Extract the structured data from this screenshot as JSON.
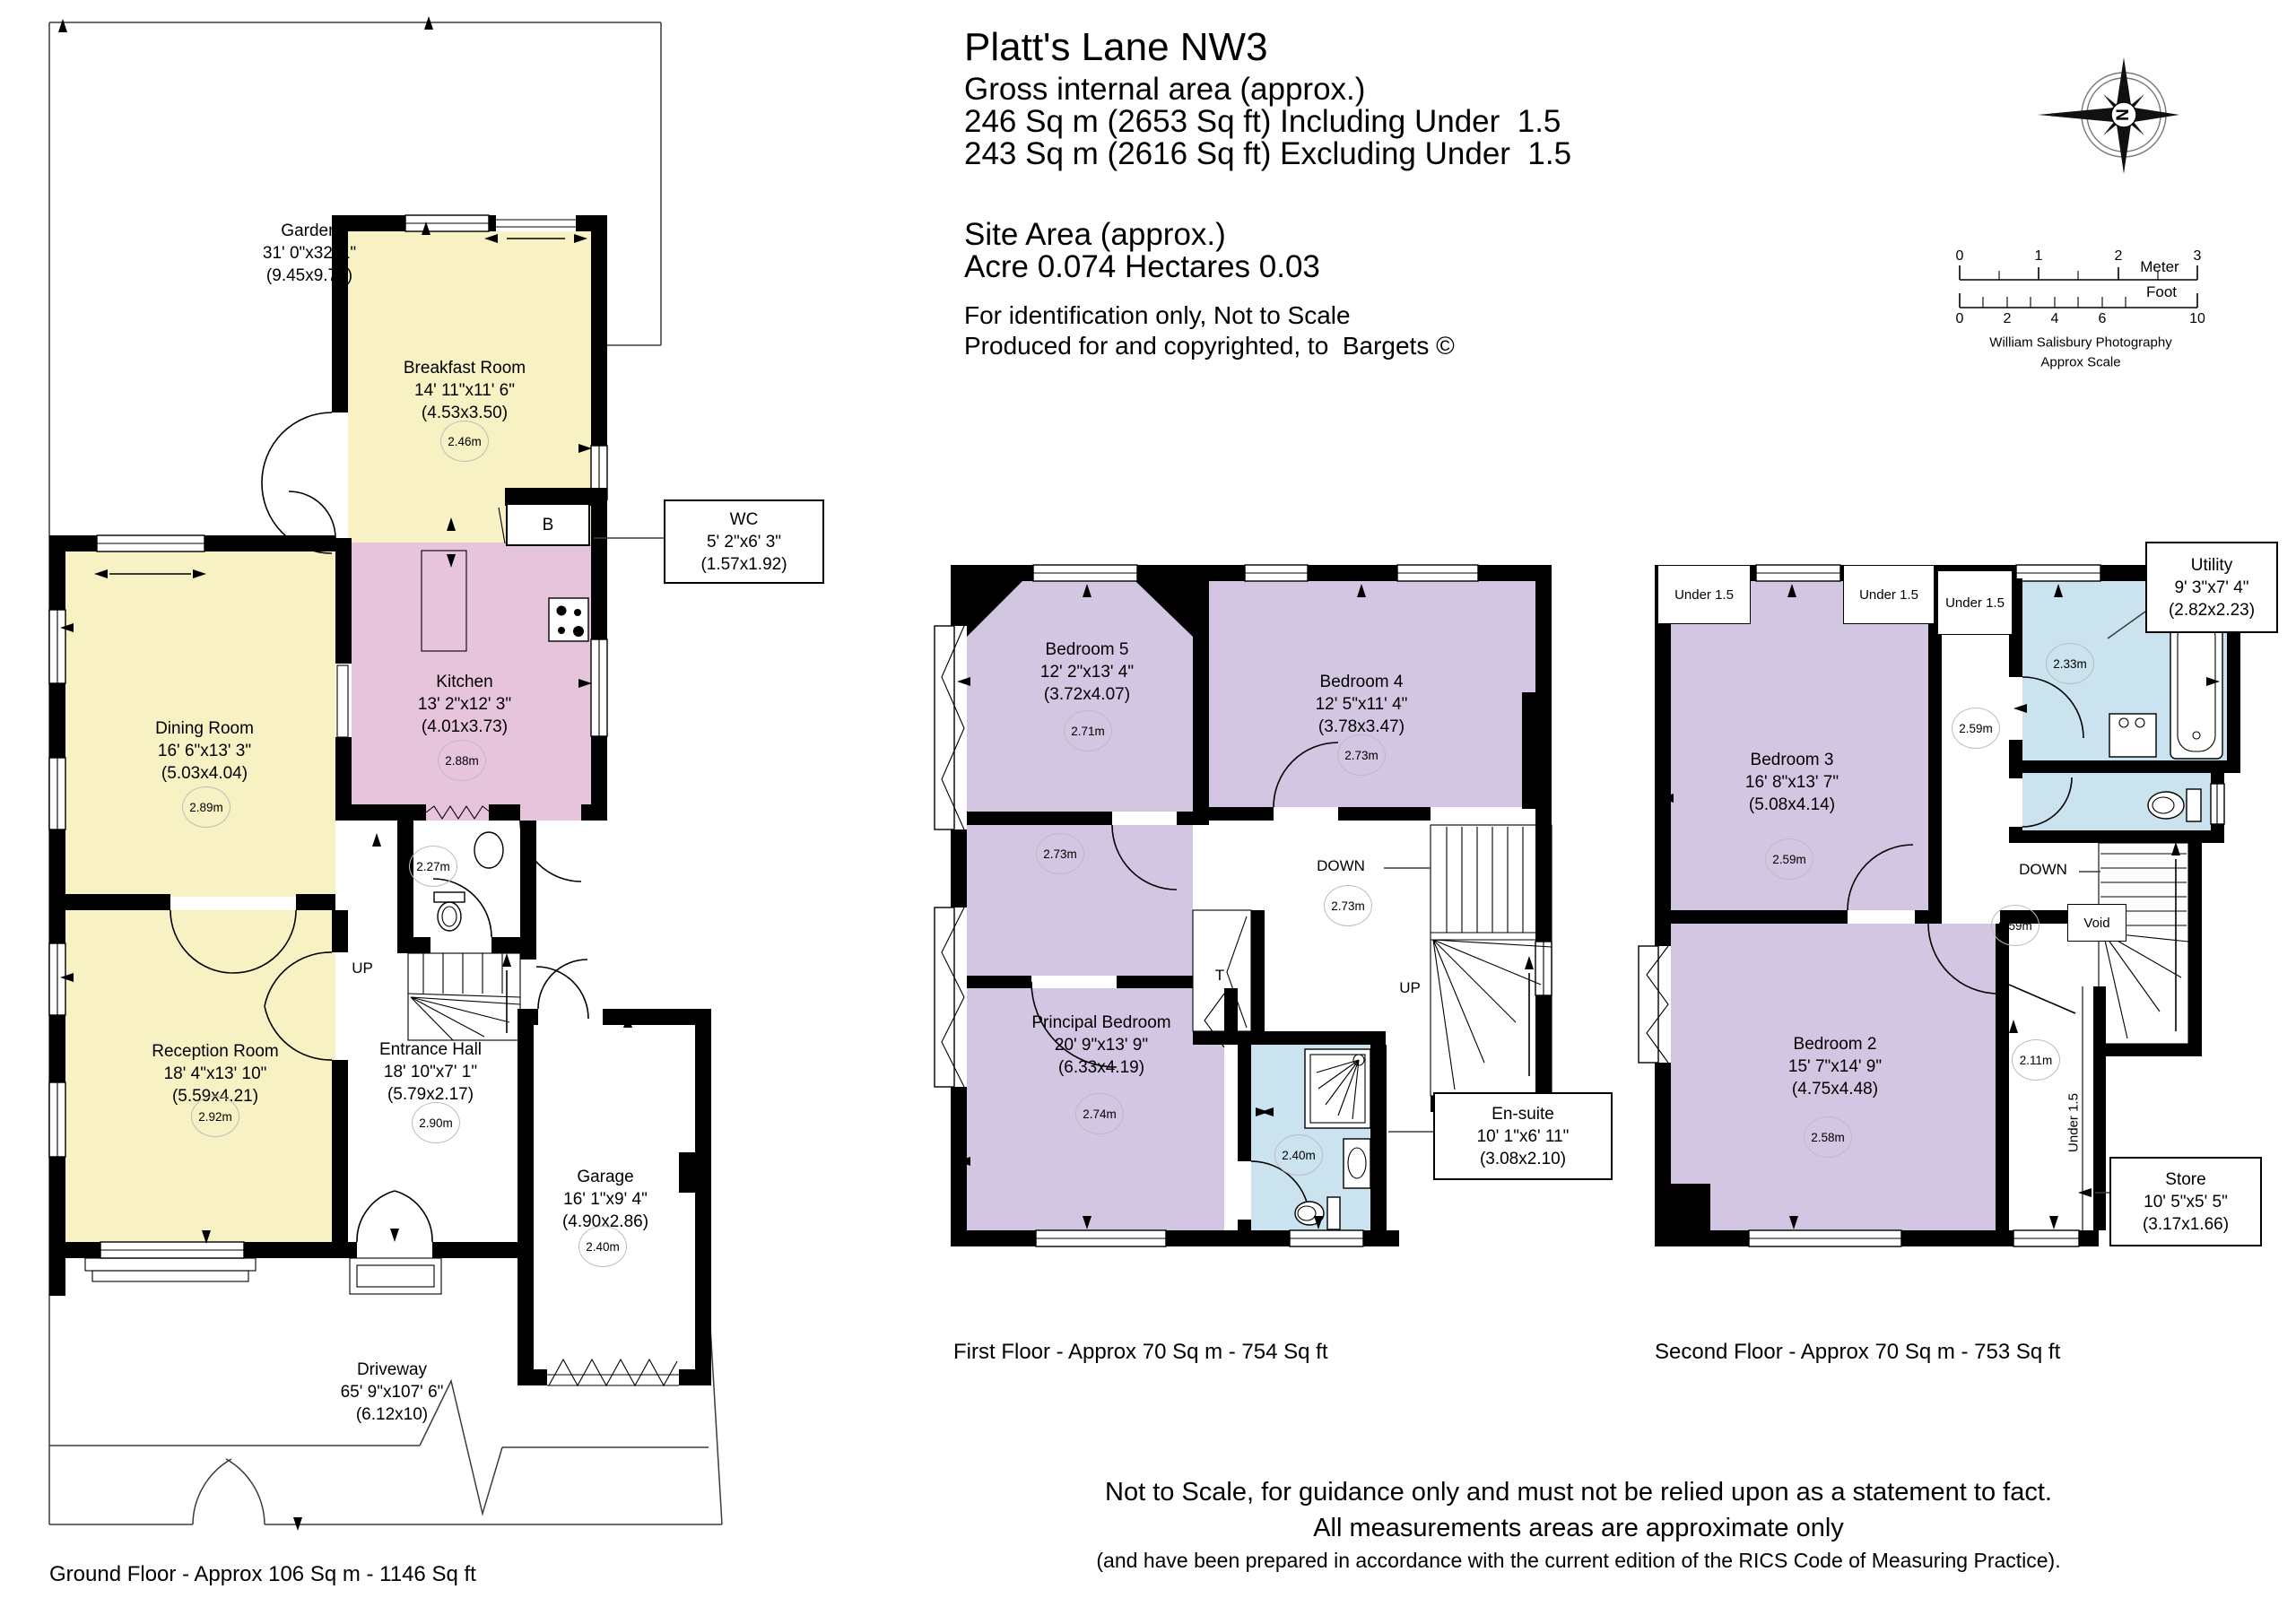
{
  "header": {
    "title": "Platt's Lane NW3",
    "gross_label": "Gross internal area (approx.)",
    "gross_line1": "246 Sq m (2653 Sq ft) Including Under  1.5",
    "gross_line2": "243 Sq m (2616 Sq ft) Excluding Under  1.5",
    "site_area_label": "Site Area (approx.)",
    "site_area_value": "Acre 0.074 Hectares 0.03",
    "note1": "For identification only, Not to Scale",
    "note2": "Produced for and copyrighted, to  Bargets ©"
  },
  "compass": {
    "north": "N"
  },
  "scale_bar": {
    "meter_ticks": [
      "0",
      "1",
      "2",
      "3"
    ],
    "meter_label": "Meter",
    "foot_ticks": [
      "0",
      "2",
      "4",
      "6",
      "10"
    ],
    "foot_label": "Foot",
    "credit1": "William Salisbury Photography",
    "credit2": "Approx Scale"
  },
  "colors": {
    "c-yellow": "#F8F1C4",
    "c-pink": "#E6C4DC",
    "c-purple": "#D3C6E2",
    "c-blue": "#CBE3EF",
    "c-wall": "#000000"
  },
  "ground_floor": {
    "caption": "Ground Floor - Approx 106 Sq m - 1146 Sq ft",
    "garden": {
      "name": "Garden",
      "dims_ft": "31' 0\"x32' 1\"",
      "dims_m": "(9.45x9.77)"
    },
    "driveway": {
      "name": "Driveway",
      "dims_ft": "65' 9\"x107' 6\"",
      "dims_m": "(6.12x10)"
    },
    "breakfast": {
      "name": "Breakfast Room",
      "dims_ft": "14' 11\"x11' 6\"",
      "dims_m": "(4.53x3.50)",
      "height": "2.46m"
    },
    "kitchen": {
      "name": "Kitchen",
      "dims_ft": "13' 2\"x12' 3\"",
      "dims_m": "(4.01x3.73)",
      "height": "2.88m"
    },
    "dining": {
      "name": "Dining Room",
      "dims_ft": "16' 6\"x13' 3\"",
      "dims_m": "(5.03x4.04)",
      "height": "2.89m"
    },
    "reception": {
      "name": "Reception Room",
      "dims_ft": "18' 4\"x13' 10\"",
      "dims_m": "(5.59x4.21)",
      "height": "2.92m"
    },
    "hall": {
      "name": "Entrance Hall",
      "dims_ft": "18' 10\"x7' 1\"",
      "dims_m": "(5.79x2.17)",
      "height": "2.90m"
    },
    "garage": {
      "name": "Garage",
      "dims_ft": "16' 1\"x9' 4\"",
      "dims_m": "(4.90x2.86)",
      "height": "2.40m"
    },
    "wc_box": {
      "name": "WC",
      "dims_ft": "5' 2\"x6' 3\"",
      "dims_m": "(1.57x1.92)"
    },
    "wc_height": "2.27m",
    "up_label": "UP",
    "boiler_label": "B"
  },
  "first_floor": {
    "caption": "First Floor - Approx 70 Sq m - 754 Sq ft",
    "bedroom5": {
      "name": "Bedroom 5",
      "dims_ft": "12' 2\"x13' 4\"",
      "dims_m": "(3.72x4.07)",
      "height": "2.71m"
    },
    "bedroom4": {
      "name": "Bedroom 4",
      "dims_ft": "12' 5\"x11' 4\"",
      "dims_m": "(3.78x3.47)",
      "height": "2.73m"
    },
    "principal": {
      "name": "Principal Bedroom",
      "dims_ft": "20' 9\"x13' 9\"",
      "dims_m": "(6.33x4.19)",
      "height": "2.74m"
    },
    "dressing_height": "2.73m",
    "landing_height": "2.73m",
    "ensuite_box": {
      "name": "En-suite",
      "dims_ft": "10' 1\"x6' 11\"",
      "dims_m": "(3.08x2.10)"
    },
    "ensuite_height": "2.40m",
    "down_label": "DOWN",
    "up_label": "UP",
    "tank_label": "T"
  },
  "second_floor": {
    "caption": "Second Floor - Approx 70 Sq m - 753 Sq ft",
    "bedroom3": {
      "name": "Bedroom 3",
      "dims_ft": "16' 8\"x13' 7\"",
      "dims_m": "(5.08x4.14)",
      "height": "2.59m"
    },
    "bedroom2": {
      "name": "Bedroom 2",
      "dims_ft": "15' 7\"x14' 9\"",
      "dims_m": "(4.75x4.48)",
      "height": "2.58m"
    },
    "utility_box": {
      "name": "Utility",
      "dims_ft": "9' 3\"x7' 4\"",
      "dims_m": "(2.82x2.23)"
    },
    "store_box": {
      "name": "Store",
      "dims_ft": "10' 5\"x5' 5\"",
      "dims_m": "(3.17x1.66)"
    },
    "bath_height": "2.33m",
    "hall_height": "2.59m",
    "landing_height": "2.59m",
    "hallway_height": "2.11m",
    "under15_a": "Under 1.5",
    "under15_b": "Under 1.5",
    "under15_c": "Under 1.5",
    "under15_vertical": "Under 1.5",
    "void_label": "Void",
    "down_label": "DOWN"
  },
  "disclaimer": {
    "line1": "Not to Scale, for guidance only and must not be relied upon as a statement to fact.",
    "line2": "All measurements areas are approximate only",
    "line3": "(and have been prepared in accordance with the current edition of the RICS Code of Measuring Practice)."
  }
}
